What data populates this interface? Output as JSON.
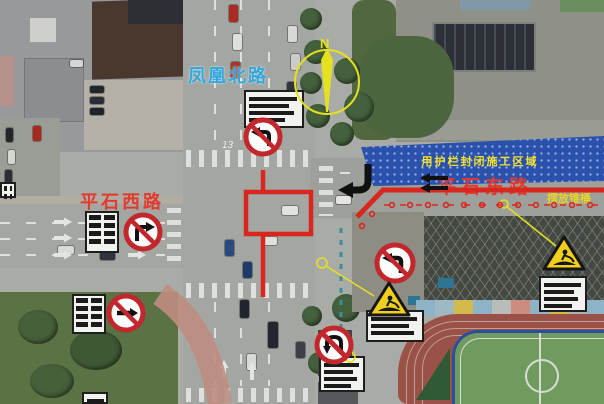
{
  "map": {
    "labels": {
      "north_road": "凤凰北路",
      "west_road": "平石西路",
      "east_road": "平石东路",
      "closure_area": "用护栏封闭施工区域",
      "cones_note": "摆放锥桶",
      "compass_north": "N",
      "pavement_marking": "13"
    },
    "colors": {
      "overlay_red": "#d8271f",
      "road_label_blue": "#2fa8de",
      "road_label_red": "#e23a2c",
      "closure_banner_blue": "#2a52ad",
      "closure_text_yellow": "#f7e32a",
      "compass_yellow": "#e5e020",
      "warning_sign_yellow": "#f2cf1d",
      "prohibition_sign_red": "#c1272d"
    },
    "signs": {
      "prohibition": [
        {
          "id": "no-left-turn-north-approach",
          "type": "no-left-turn"
        },
        {
          "id": "no-right-turn-west-approach",
          "type": "no-right-turn"
        },
        {
          "id": "no-straight-west-south",
          "type": "no-straight"
        },
        {
          "id": "no-left-turn-east-approach",
          "type": "no-left-turn"
        },
        {
          "id": "no-u-turn-south-approach",
          "type": "no-u-turn"
        }
      ],
      "warning": [
        {
          "id": "construction-warning-left",
          "type": "construction-ahead"
        },
        {
          "id": "construction-warning-right",
          "type": "construction-ahead"
        }
      ],
      "notice_board_count": 8
    }
  }
}
